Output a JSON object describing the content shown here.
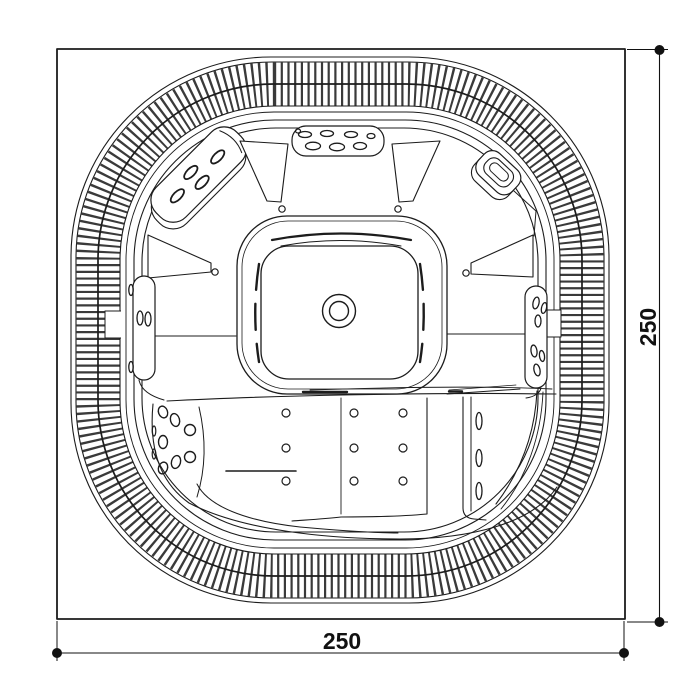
{
  "drawing": {
    "subject": "hot-tub-spa-top-view-plan",
    "dimensions": {
      "bottom_label": "250",
      "right_label": "250"
    },
    "colors": {
      "background": "#ffffff",
      "line": "#1c1c1c",
      "hatch": "#3a3a3a",
      "dimension": "#111111"
    }
  }
}
